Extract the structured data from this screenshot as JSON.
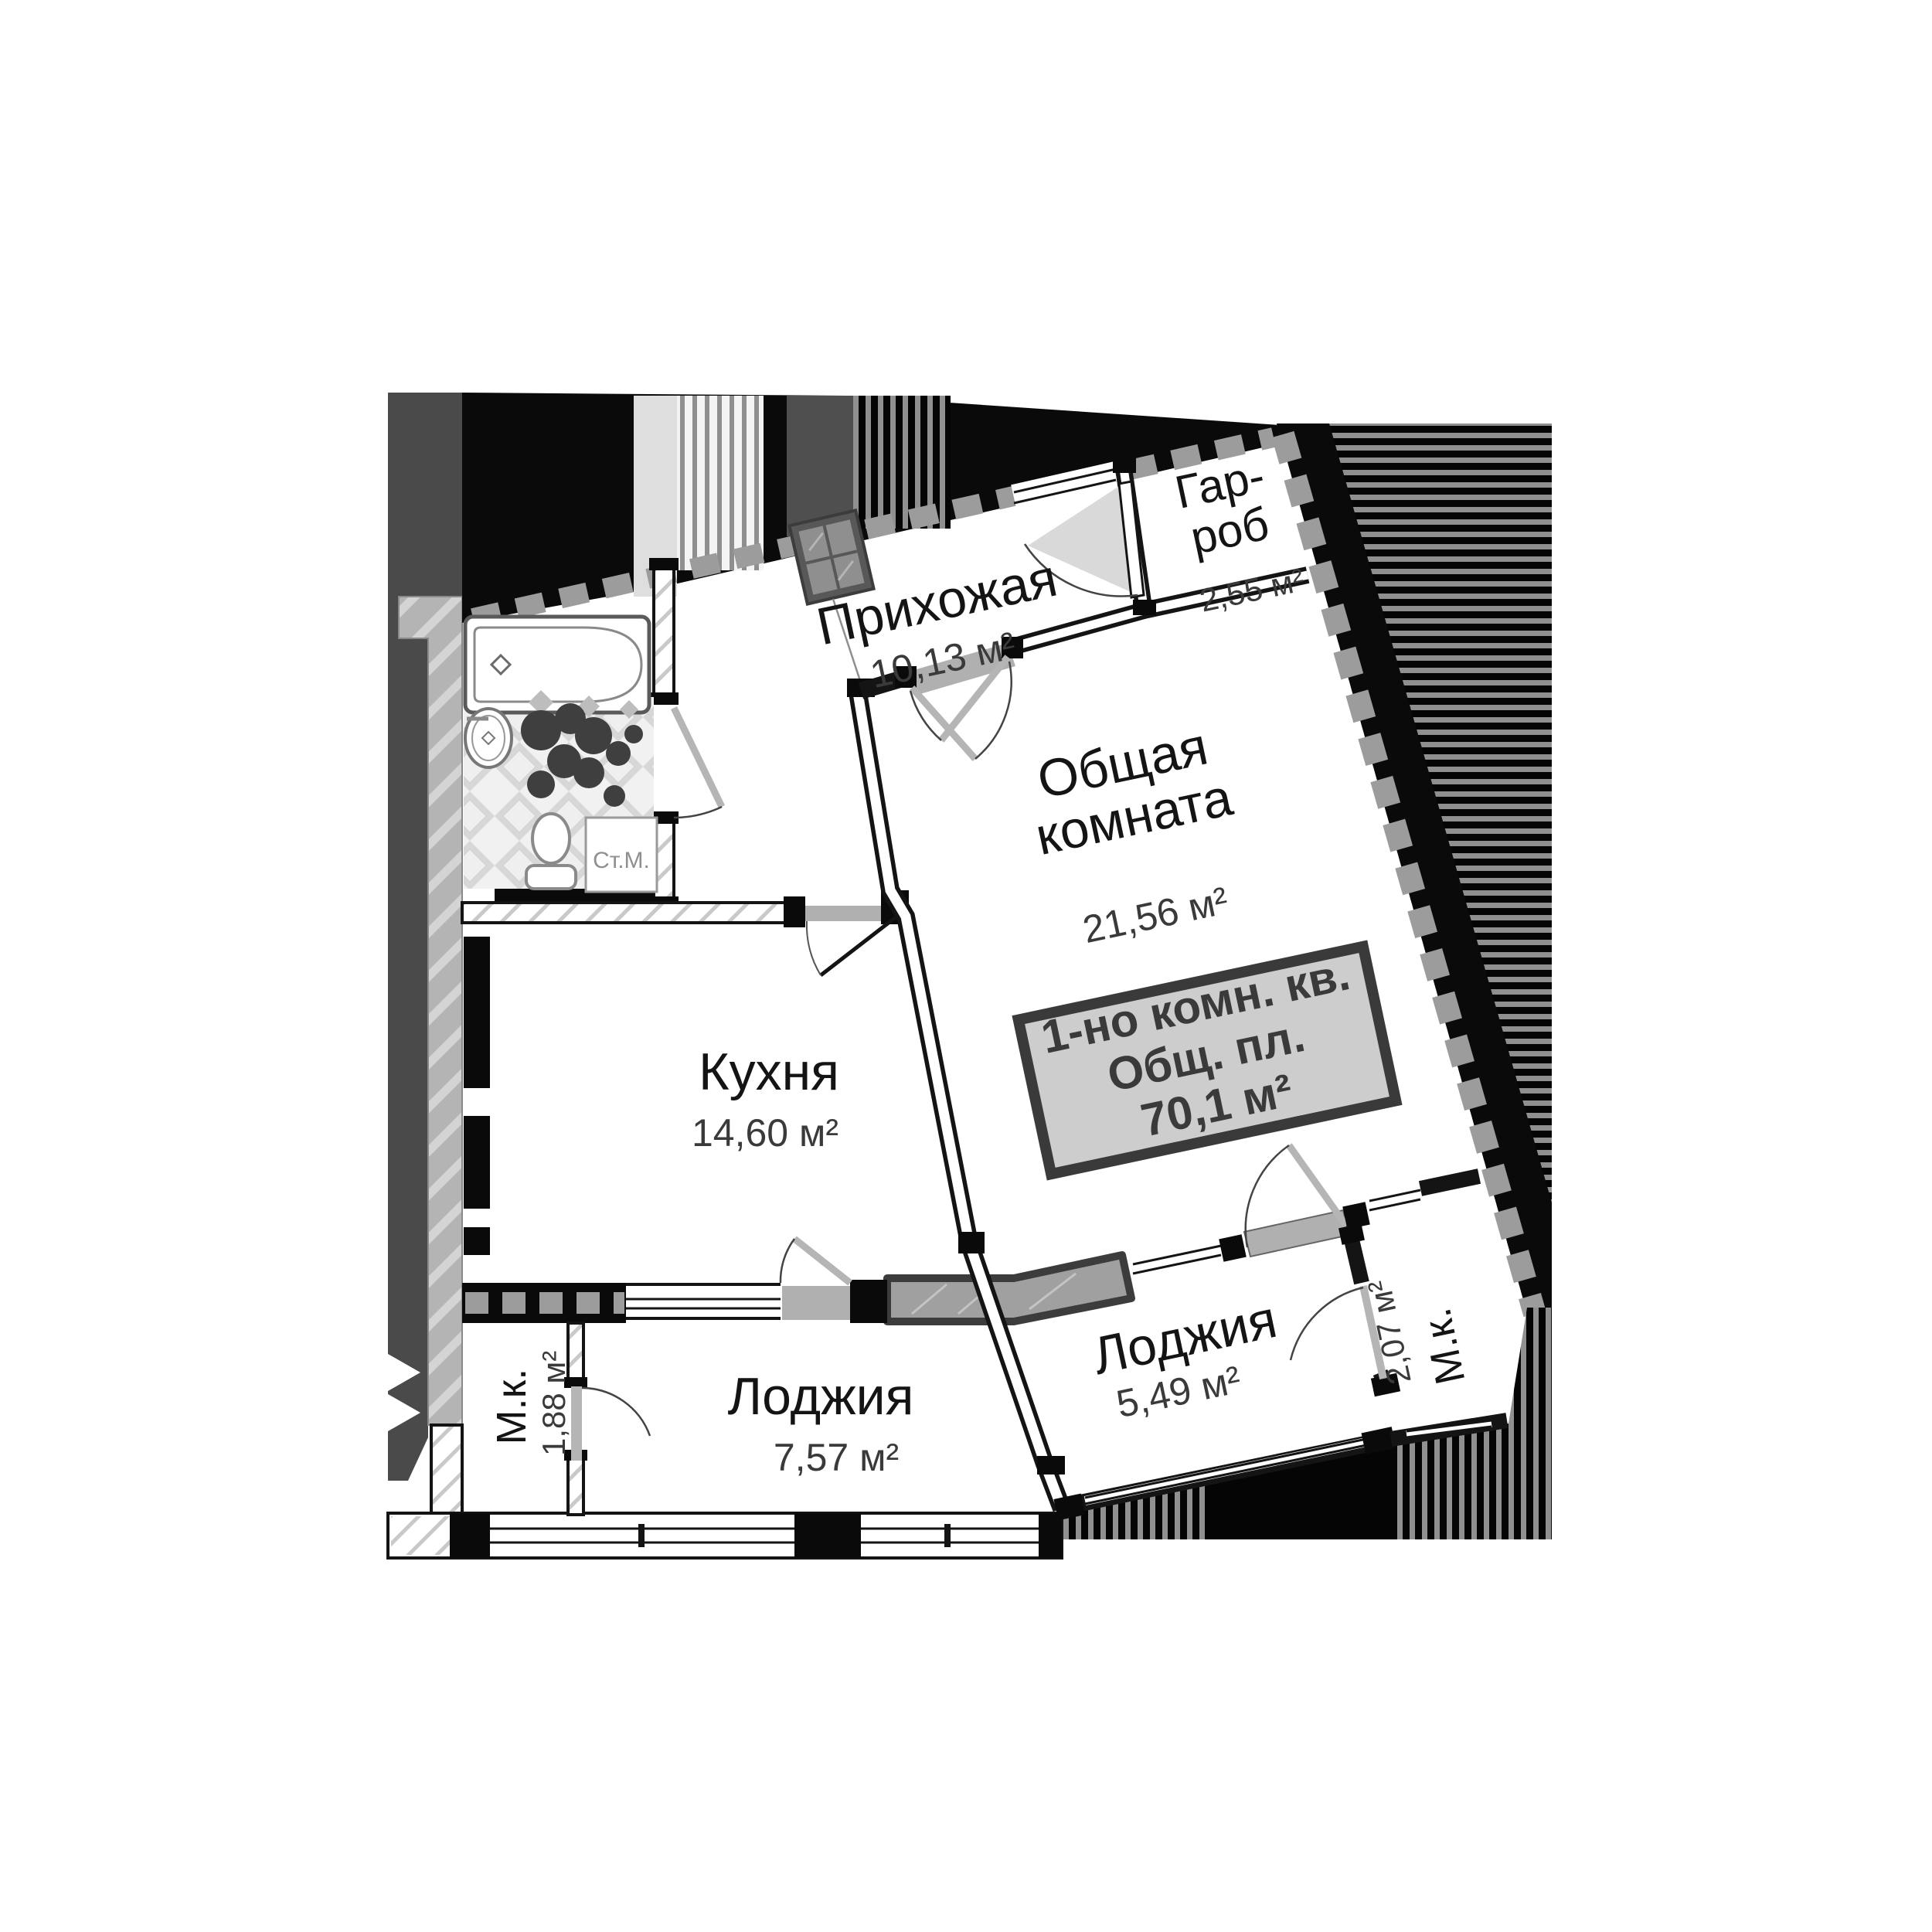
{
  "plan": {
    "title": "floor-plan-apartment",
    "rooms": [
      {
        "id": "prihozhaya",
        "name": "Прихожая",
        "area": "10,13 м²"
      },
      {
        "id": "garderob",
        "name_line1": "Гар-",
        "name_line2": "роб",
        "area": "2,55 м²"
      },
      {
        "id": "obshchaya",
        "name_line1": "Общая",
        "name_line2": "комната",
        "area": "21,56 м²"
      },
      {
        "id": "kuhnya",
        "name": "Кухня",
        "area": "14,60 м²"
      },
      {
        "id": "mk_left",
        "name": "М.к.",
        "area": "1,88 м²"
      },
      {
        "id": "lodzhiya_left",
        "name": "Лоджия",
        "area": "7,57 м²"
      },
      {
        "id": "lodzhiya_right",
        "name": "Лоджия",
        "area": "5,49 м²"
      },
      {
        "id": "mk_right",
        "name": "М.к.",
        "area": "2,07 м²"
      }
    ],
    "info_box": {
      "line1": "1-но комн. кв.",
      "line2": "Общ. пл.",
      "line3": "70,1 м²"
    },
    "appliance_label": "Ст.М.",
    "colors": {
      "wall_black": "#0a0a0a",
      "neighbor_dark_gray": "#4a4a4a",
      "concrete_hatch_gray": "#b4b4b4",
      "zigzag_gray": "#9c9c9c",
      "door_threshold_gray": "#b0b0b0",
      "info_box_bg": "#cdcdcd",
      "info_box_border": "#3a3a3a"
    }
  }
}
